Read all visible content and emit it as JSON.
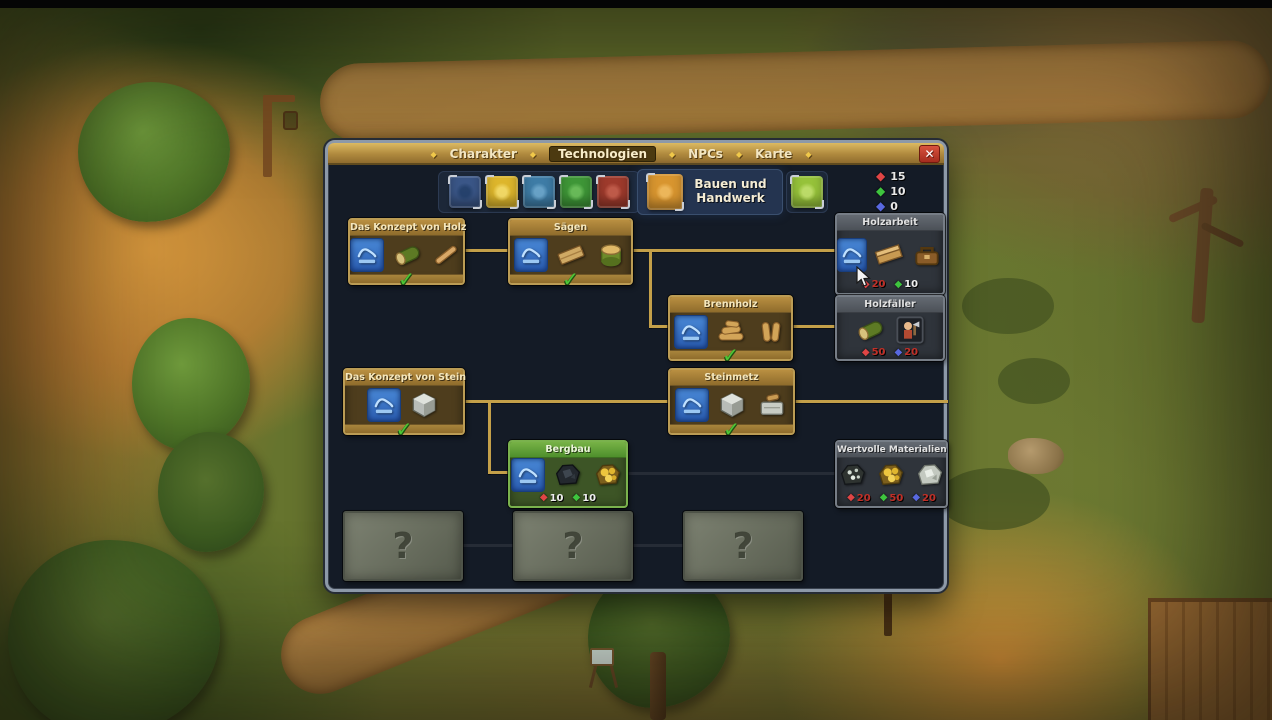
{
  "glyphs": {
    "check": "✓",
    "unknown": "?",
    "diamond": "◆",
    "close": "✕"
  },
  "window": {
    "tabs": [
      {
        "label": "Charakter",
        "active": false
      },
      {
        "label": "Technologien",
        "active": true
      },
      {
        "label": "NPCs",
        "active": false
      },
      {
        "label": "Karte",
        "active": false
      }
    ]
  },
  "categories": {
    "selected": {
      "label": "Bauen und Handwerk",
      "icon": "building-crafting-book"
    },
    "books": [
      {
        "icon": "theology-book",
        "color": "#3a5687"
      },
      {
        "icon": "alchemy-book",
        "color": "#ddb62c"
      },
      {
        "icon": "writing-book",
        "color": "#3e7ca6"
      },
      {
        "icon": "nature-book",
        "color": "#3e9637"
      },
      {
        "icon": "cooking-book",
        "color": "#9e3a2c"
      },
      {
        "icon": "smithing-book",
        "color": "#96c23a"
      }
    ]
  },
  "points": [
    {
      "name": "red-points",
      "color": "#e04545",
      "value": 15
    },
    {
      "name": "green-points",
      "color": "#3ec43e",
      "value": 10
    },
    {
      "name": "blue-points",
      "color": "#5868e0",
      "value": 0
    }
  ],
  "tree": {
    "nodes": [
      {
        "title": "Das Konzept von Holz",
        "state": "researched",
        "icons": [
          "blueprint",
          "log",
          "stick"
        ]
      },
      {
        "title": "Sägen",
        "state": "researched",
        "icons": [
          "blueprint",
          "plank",
          "billet"
        ]
      },
      {
        "title": "Holzarbeit",
        "state": "locked",
        "icons": [
          "blueprint",
          "beam",
          "toolbox"
        ],
        "costs": [
          {
            "color": "red",
            "value": 20,
            "affordable": false
          },
          {
            "color": "green",
            "value": 10,
            "affordable": true
          }
        ]
      },
      {
        "title": "Brennholz",
        "state": "researched",
        "icons": [
          "blueprint",
          "firewood",
          "billets"
        ]
      },
      {
        "title": "Holzfäller",
        "state": "locked",
        "icons": [
          "log",
          "npc-portrait"
        ],
        "costs": [
          {
            "color": "red",
            "value": 50,
            "affordable": false
          },
          {
            "color": "blue",
            "value": 20,
            "affordable": false
          }
        ]
      },
      {
        "title": "Das Konzept von Stein",
        "state": "researched",
        "icons": [
          "blueprint",
          "stone-block"
        ]
      },
      {
        "title": "Steinmetz",
        "state": "researched",
        "icons": [
          "blueprint",
          "stone-block",
          "chisel"
        ]
      },
      {
        "title": "Bergbau",
        "state": "available",
        "icons": [
          "blueprint",
          "coal-ore",
          "gold-ore"
        ],
        "costs": [
          {
            "color": "red",
            "value": 10,
            "affordable": true
          },
          {
            "color": "green",
            "value": 10,
            "affordable": true
          }
        ]
      },
      {
        "title": "Wertvolle Materialien",
        "state": "locked",
        "icons": [
          "silver-ore",
          "gold-ore",
          "white-ore"
        ],
        "costs": [
          {
            "color": "red",
            "value": 20,
            "affordable": false
          },
          {
            "color": "green",
            "value": 50,
            "affordable": false
          },
          {
            "color": "blue",
            "value": 20,
            "affordable": false
          }
        ]
      }
    ],
    "unknown_nodes": 3
  }
}
